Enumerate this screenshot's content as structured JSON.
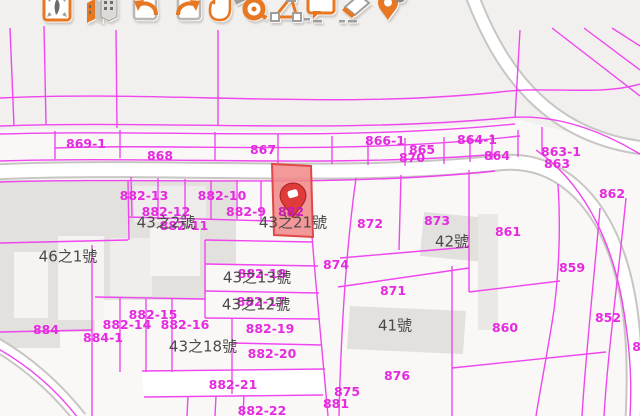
{
  "app": {
    "kind": "cadastral-map-viewer"
  },
  "toolbar": {
    "icons": [
      {
        "name": "zoom-full-extent-icon",
        "title": "Full extent",
        "x": 57
      },
      {
        "name": "buildings-3d-icon",
        "title": "3D buildings",
        "x": 101
      },
      {
        "name": "previous-view-icon",
        "title": "Previous view",
        "x": 146
      },
      {
        "name": "next-view-icon",
        "title": "Next view",
        "x": 188
      },
      {
        "name": "pan-icon",
        "title": "Pan map",
        "x": 220
      },
      {
        "name": "measure-distance-icon",
        "title": "Measure distance",
        "x": 250
      },
      {
        "name": "measure-area-icon",
        "title": "Measure area",
        "x": 285
      },
      {
        "name": "map-tip-icon",
        "title": "Map tip",
        "x": 320
      },
      {
        "name": "eraser-icon",
        "title": "Erase",
        "x": 355
      },
      {
        "name": "clear-marker-icon",
        "title": "Clear marker",
        "x": 390
      }
    ]
  },
  "map": {
    "colors": {
      "parcel_line": "#ef3def",
      "parcel_label": "#e52ae0",
      "address_label": "#4b4a48",
      "highlight_fill": "#f18787",
      "highlight_stroke": "#e04848",
      "marker_red": "#e03b3b",
      "toolbar_orange": "#e87722",
      "road_fill": "#ffffff",
      "building_fill": "#e3e1de"
    },
    "highlighted_parcel": {
      "label": "882",
      "marker": "red location pin"
    },
    "labels": [
      {
        "text": "869-1",
        "x": 86,
        "y": 144,
        "kind": "parcel"
      },
      {
        "text": "868",
        "x": 160,
        "y": 156,
        "kind": "parcel"
      },
      {
        "text": "867",
        "x": 263,
        "y": 150,
        "kind": "parcel"
      },
      {
        "text": "866-1",
        "x": 385,
        "y": 141,
        "kind": "parcel"
      },
      {
        "text": "865",
        "x": 422,
        "y": 150,
        "kind": "parcel"
      },
      {
        "text": "864-1",
        "x": 477,
        "y": 140,
        "kind": "parcel"
      },
      {
        "text": "870",
        "x": 412,
        "y": 158,
        "kind": "parcel"
      },
      {
        "text": "864",
        "x": 497,
        "y": 156,
        "kind": "parcel"
      },
      {
        "text": "863-1",
        "x": 561,
        "y": 152,
        "kind": "parcel"
      },
      {
        "text": "863",
        "x": 557,
        "y": 164,
        "kind": "parcel"
      },
      {
        "text": "862",
        "x": 612,
        "y": 194,
        "kind": "parcel"
      },
      {
        "text": "882-13",
        "x": 144,
        "y": 196,
        "kind": "parcel"
      },
      {
        "text": "882-10",
        "x": 222,
        "y": 196,
        "kind": "parcel"
      },
      {
        "text": "882-12",
        "x": 166,
        "y": 212,
        "kind": "parcel"
      },
      {
        "text": "882-9",
        "x": 246,
        "y": 212,
        "kind": "parcel"
      },
      {
        "text": "882-11",
        "x": 184,
        "y": 226,
        "kind": "parcel"
      },
      {
        "text": "882",
        "x": 291,
        "y": 212,
        "kind": "highlight"
      },
      {
        "text": "872",
        "x": 370,
        "y": 224,
        "kind": "parcel"
      },
      {
        "text": "873",
        "x": 437,
        "y": 221,
        "kind": "parcel"
      },
      {
        "text": "861",
        "x": 508,
        "y": 232,
        "kind": "parcel"
      },
      {
        "text": "874",
        "x": 336,
        "y": 265,
        "kind": "parcel"
      },
      {
        "text": "859",
        "x": 572,
        "y": 268,
        "kind": "parcel"
      },
      {
        "text": "871",
        "x": 393,
        "y": 291,
        "kind": "parcel"
      },
      {
        "text": "882-18",
        "x": 262,
        "y": 274,
        "kind": "parcel"
      },
      {
        "text": "882-17",
        "x": 261,
        "y": 302,
        "kind": "parcel"
      },
      {
        "text": "882-15",
        "x": 153,
        "y": 315,
        "kind": "parcel"
      },
      {
        "text": "882-14",
        "x": 127,
        "y": 325,
        "kind": "parcel"
      },
      {
        "text": "882-16",
        "x": 185,
        "y": 325,
        "kind": "parcel"
      },
      {
        "text": "884",
        "x": 46,
        "y": 330,
        "kind": "parcel"
      },
      {
        "text": "884-1",
        "x": 103,
        "y": 338,
        "kind": "parcel"
      },
      {
        "text": "882-19",
        "x": 270,
        "y": 329,
        "kind": "parcel"
      },
      {
        "text": "860",
        "x": 505,
        "y": 328,
        "kind": "parcel"
      },
      {
        "text": "852",
        "x": 608,
        "y": 318,
        "kind": "parcel"
      },
      {
        "text": "882-20",
        "x": 272,
        "y": 354,
        "kind": "parcel"
      },
      {
        "text": "882-21",
        "x": 233,
        "y": 385,
        "kind": "parcel"
      },
      {
        "text": "875",
        "x": 347,
        "y": 392,
        "kind": "parcel"
      },
      {
        "text": "876",
        "x": 397,
        "y": 376,
        "kind": "parcel"
      },
      {
        "text": "881",
        "x": 336,
        "y": 404,
        "kind": "parcel"
      },
      {
        "text": "882-22",
        "x": 262,
        "y": 411,
        "kind": "parcel"
      },
      {
        "text": "85",
        "x": 641,
        "y": 347,
        "kind": "parcel"
      },
      {
        "text": "46之1號",
        "x": 68,
        "y": 257,
        "kind": "address"
      },
      {
        "text": "43之2號",
        "x": 166,
        "y": 223,
        "kind": "address"
      },
      {
        "text": "43之21號",
        "x": 293,
        "y": 223,
        "kind": "address"
      },
      {
        "text": "42號",
        "x": 452,
        "y": 242,
        "kind": "address"
      },
      {
        "text": "43之13號",
        "x": 257,
        "y": 278,
        "kind": "address"
      },
      {
        "text": "43之12號",
        "x": 256,
        "y": 305,
        "kind": "address"
      },
      {
        "text": "43之18號",
        "x": 203,
        "y": 347,
        "kind": "address"
      },
      {
        "text": "41號",
        "x": 395,
        "y": 326,
        "kind": "address"
      }
    ]
  }
}
